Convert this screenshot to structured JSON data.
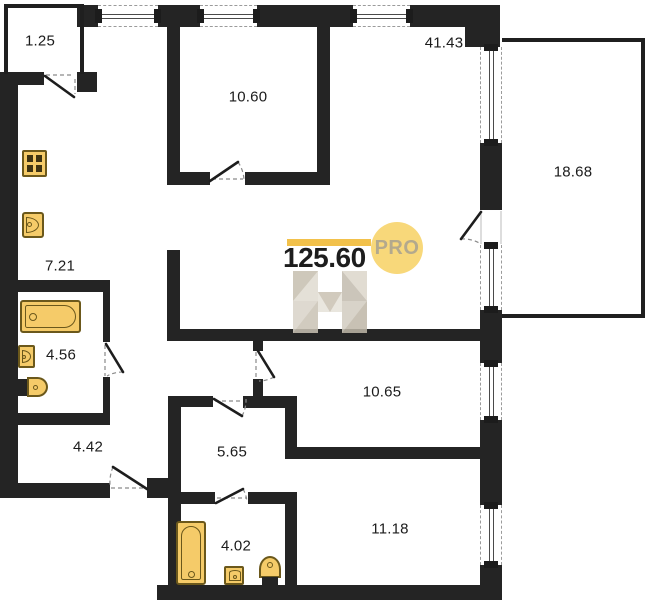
{
  "floorplan": {
    "total_area": "125.60",
    "badge_label": "PRO",
    "rooms": [
      {
        "name": "balcony",
        "area": "1.25"
      },
      {
        "name": "room-top",
        "area": "10.60"
      },
      {
        "name": "living-room",
        "area": "41.43"
      },
      {
        "name": "terrace",
        "area": "18.68"
      },
      {
        "name": "kitchen",
        "area": "7.21"
      },
      {
        "name": "bathroom-1",
        "area": "4.56"
      },
      {
        "name": "entry-hall",
        "area": "4.42"
      },
      {
        "name": "inner-hall",
        "area": "5.65"
      },
      {
        "name": "room-mid",
        "area": "10.65"
      },
      {
        "name": "room-bottom",
        "area": "11.18"
      },
      {
        "name": "bathroom-2",
        "area": "4.02"
      }
    ],
    "colors": {
      "wall": "#242424",
      "accent_yellow": "#F2C14B",
      "fixture_fill": "#F5CB69",
      "fixture_stroke": "#6B581B",
      "badge_bg": "#F8D87A",
      "badge_text": "#B3A98D"
    },
    "fixtures": [
      "stove",
      "kitchen-sink",
      "bathtub",
      "wash-sink",
      "toilet",
      "bathtub-2",
      "wash-sink-2",
      "toilet-2"
    ]
  }
}
